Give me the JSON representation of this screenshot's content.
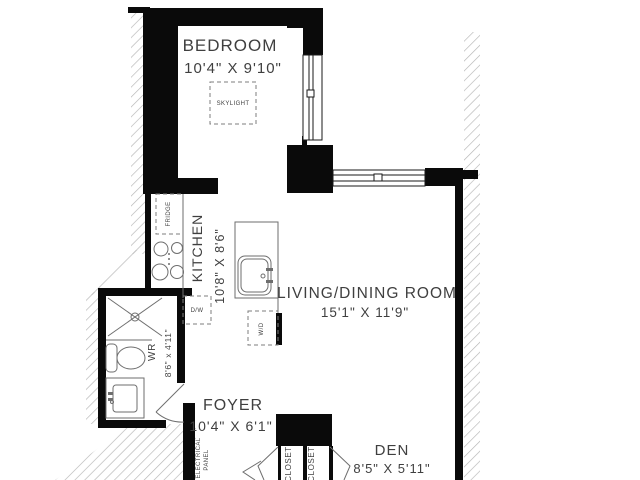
{
  "plan": {
    "rooms": {
      "bedroom": {
        "label": "BEDROOM",
        "dims": "10'4\" X 9'10\""
      },
      "kitchen": {
        "label": "KITCHEN",
        "dims": "10'8\" X 8'6\""
      },
      "living": {
        "label": "LIVING/DINING ROOM",
        "dims": "15'1\" X 11'9\""
      },
      "wr": {
        "label": "WR",
        "dims": "8'6\" x 4'11\""
      },
      "foyer": {
        "label": "FOYER",
        "dims": "10'4\" X 6'1\""
      },
      "den": {
        "label": "DEN",
        "dims": "8'5\" X 5'11\""
      }
    },
    "fixtures": {
      "skylight": "SKYLIGHT",
      "fridge": "FRIDGE",
      "dishwasher": "D/W",
      "washer_dryer": "W/D",
      "closet_left": "CLOSET",
      "closet_right": "CLOSET",
      "electrical_line1": "ELECTRICAL",
      "electrical_line2": "PANEL"
    },
    "colors": {
      "wall": "#0a0a0a",
      "text": "#3f3f3f",
      "hatch": "#b5b5b5",
      "fixture_stroke": "#6e6e6e"
    }
  }
}
